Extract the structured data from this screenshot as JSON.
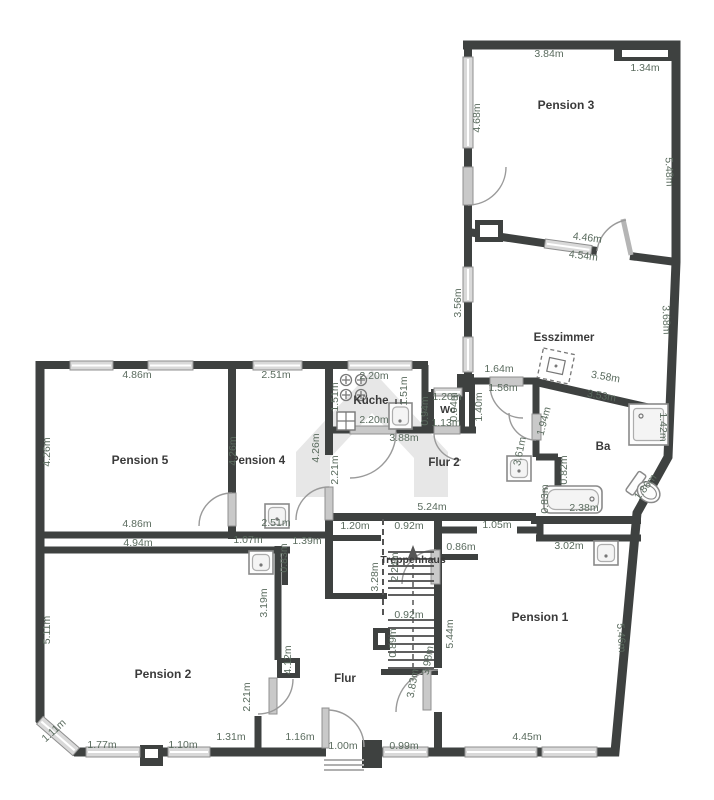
{
  "plan": {
    "type": "floor-plan",
    "language": "de",
    "watermark": "house-logo-watermark"
  },
  "colors": {
    "wall": "#3e4140",
    "dimension_text": "#5a6b5e",
    "room_text": "#3a3a3a",
    "window_fill": "#d9d9d9",
    "door_leaf": "#c9c9c9",
    "watermark": "#e7e7e7",
    "fixture_stroke": "#8a8a8a"
  },
  "room_labels": [
    {
      "id": "pension-3",
      "text": "Pension 3",
      "x": 566,
      "y": 109,
      "fs": 12
    },
    {
      "id": "esszimmer",
      "text": "Esszimmer",
      "x": 564,
      "y": 341,
      "fs": 11.5
    },
    {
      "id": "ba",
      "text": "Ba",
      "x": 603,
      "y": 450,
      "fs": 11.5
    },
    {
      "id": "kueche",
      "text": "Küche",
      "x": 371,
      "y": 404,
      "fs": 11.5
    },
    {
      "id": "wc",
      "text": "Wc",
      "x": 448,
      "y": 413,
      "fs": 10.5
    },
    {
      "id": "flur-2",
      "text": "Flur 2",
      "x": 444,
      "y": 466,
      "fs": 11.5
    },
    {
      "id": "treppenhaus",
      "text": "Treppenhaus",
      "x": 413,
      "y": 563,
      "fs": 10.5
    },
    {
      "id": "pension-1",
      "text": "Pension 1",
      "x": 540,
      "y": 621,
      "fs": 12
    },
    {
      "id": "flur",
      "text": "Flur",
      "x": 345,
      "y": 682,
      "fs": 11.5
    },
    {
      "id": "pension-2",
      "text": "Pension 2",
      "x": 163,
      "y": 678,
      "fs": 12
    },
    {
      "id": "pension-4",
      "text": "Pension 4",
      "x": 258,
      "y": 464,
      "fs": 11.5
    },
    {
      "id": "pension-5",
      "text": "Pension 5",
      "x": 140,
      "y": 464,
      "fs": 12
    }
  ],
  "dimension_labels": [
    {
      "text": "3.84m",
      "x": 549,
      "y": 57,
      "rot": 0
    },
    {
      "text": "1.34m",
      "x": 645,
      "y": 71,
      "rot": 0
    },
    {
      "text": "4.68m",
      "x": 480,
      "y": 118,
      "rot": -90
    },
    {
      "text": "5.48m",
      "x": 666,
      "y": 172,
      "rot": 88
    },
    {
      "text": "4.46m",
      "x": 587,
      "y": 241,
      "rot": 7
    },
    {
      "text": "4.54m",
      "x": 583,
      "y": 259,
      "rot": 7
    },
    {
      "text": "3.56m",
      "x": 461,
      "y": 303,
      "rot": -90
    },
    {
      "text": "3.68m",
      "x": 663,
      "y": 320,
      "rot": 88
    },
    {
      "text": "1.64m",
      "x": 499,
      "y": 372,
      "rot": 0
    },
    {
      "text": "1.56m",
      "x": 503,
      "y": 391,
      "rot": 0
    },
    {
      "text": "3.58m",
      "x": 605,
      "y": 380,
      "rot": 10
    },
    {
      "text": "3.53m",
      "x": 601,
      "y": 399,
      "rot": 10
    },
    {
      "text": "1.40m",
      "x": 482,
      "y": 407,
      "rot": -90
    },
    {
      "text": "1.94m",
      "x": 547,
      "y": 422,
      "rot": -75
    },
    {
      "text": "1.42m",
      "x": 660,
      "y": 427,
      "rot": 90
    },
    {
      "text": "3.61m",
      "x": 523,
      "y": 452,
      "rot": -78
    },
    {
      "text": "0.82m",
      "x": 567,
      "y": 470,
      "rot": -90
    },
    {
      "text": "0.83m",
      "x": 548,
      "y": 499,
      "rot": -90
    },
    {
      "text": "2.38m",
      "x": 584,
      "y": 511,
      "rot": 0
    },
    {
      "text": "1.86m",
      "x": 648,
      "y": 489,
      "rot": -52
    },
    {
      "text": "2.20m",
      "x": 374,
      "y": 379,
      "rot": 0
    },
    {
      "text": "1.51m",
      "x": 338,
      "y": 397,
      "rot": -90
    },
    {
      "text": "1.51m",
      "x": 407,
      "y": 391,
      "rot": -90
    },
    {
      "text": "2.20m",
      "x": 374,
      "y": 423,
      "rot": 0
    },
    {
      "text": "3.88m",
      "x": 404,
      "y": 441,
      "rot": 0
    },
    {
      "text": "1.20m",
      "x": 447,
      "y": 400,
      "rot": 0
    },
    {
      "text": "0.94m",
      "x": 428,
      "y": 411,
      "rot": -90
    },
    {
      "text": "1.13m",
      "x": 446,
      "y": 426,
      "rot": 0
    },
    {
      "text": "0.94m",
      "x": 457,
      "y": 407,
      "rot": -90
    },
    {
      "text": "5.24m",
      "x": 432,
      "y": 510,
      "rot": 0
    },
    {
      "text": "2.21m",
      "x": 338,
      "y": 470,
      "rot": -90
    },
    {
      "text": "4.86m",
      "x": 137,
      "y": 378,
      "rot": 0
    },
    {
      "text": "2.51m",
      "x": 276,
      "y": 378,
      "rot": 0
    },
    {
      "text": "4.26m",
      "x": 50,
      "y": 452,
      "rot": -90
    },
    {
      "text": "4.26m",
      "x": 236,
      "y": 451,
      "rot": -90
    },
    {
      "text": "4.26m",
      "x": 319,
      "y": 448,
      "rot": -90
    },
    {
      "text": "4.86m",
      "x": 137,
      "y": 527,
      "rot": 0
    },
    {
      "text": "2.51m",
      "x": 276,
      "y": 526,
      "rot": 0
    },
    {
      "text": "4.94m",
      "x": 138,
      "y": 546,
      "rot": 0
    },
    {
      "text": "1.07m",
      "x": 248,
      "y": 543,
      "rot": 0
    },
    {
      "text": "0.83m",
      "x": 287,
      "y": 558,
      "rot": -90
    },
    {
      "text": "1.39m",
      "x": 307,
      "y": 544,
      "rot": 0
    },
    {
      "text": "3.19m",
      "x": 267,
      "y": 603,
      "rot": -90
    },
    {
      "text": "5.11m",
      "x": 50,
      "y": 630,
      "rot": -90
    },
    {
      "text": "4.12m",
      "x": 291,
      "y": 660,
      "rot": -90
    },
    {
      "text": "2.21m",
      "x": 250,
      "y": 697,
      "rot": -90
    },
    {
      "text": "1.20m",
      "x": 355,
      "y": 529,
      "rot": 0
    },
    {
      "text": "0.92m",
      "x": 409,
      "y": 529,
      "rot": 0
    },
    {
      "text": "1.05m",
      "x": 497,
      "y": 528,
      "rot": 0
    },
    {
      "text": "0.86m",
      "x": 461,
      "y": 550,
      "rot": 0
    },
    {
      "text": "3.02m",
      "x": 569,
      "y": 549,
      "rot": 0
    },
    {
      "text": "2.24m",
      "x": 398,
      "y": 567,
      "rot": -90
    },
    {
      "text": "3.28m",
      "x": 378,
      "y": 577,
      "rot": -90
    },
    {
      "text": "0.92m",
      "x": 409,
      "y": 618,
      "rot": 0
    },
    {
      "text": "0.89m",
      "x": 396,
      "y": 643,
      "rot": -90
    },
    {
      "text": "5.44m",
      "x": 453,
      "y": 634,
      "rot": -90
    },
    {
      "text": "3.98m",
      "x": 431,
      "y": 661,
      "rot": -80
    },
    {
      "text": "3.83m",
      "x": 416,
      "y": 684,
      "rot": -80
    },
    {
      "text": "5.46m",
      "x": 618,
      "y": 638,
      "rot": 86
    },
    {
      "text": "4.45m",
      "x": 527,
      "y": 740,
      "rot": 0
    },
    {
      "text": "1.11m",
      "x": 56,
      "y": 733,
      "rot": -42
    },
    {
      "text": "1.77m",
      "x": 102,
      "y": 748,
      "rot": 0
    },
    {
      "text": "1.10m",
      "x": 183,
      "y": 748,
      "rot": 0
    },
    {
      "text": "1.31m",
      "x": 231,
      "y": 740,
      "rot": 0
    },
    {
      "text": "1.16m",
      "x": 300,
      "y": 740,
      "rot": 0
    },
    {
      "text": "1.00m",
      "x": 343,
      "y": 749,
      "rot": 0
    },
    {
      "text": "0.99m",
      "x": 404,
      "y": 749,
      "rot": 0
    }
  ],
  "fixtures": [
    {
      "name": "stove-icon",
      "room": "kueche"
    },
    {
      "name": "kitchen-sink-icon",
      "room": "kueche"
    },
    {
      "name": "washbasin-icon",
      "room": "pension-4"
    },
    {
      "name": "washbasin-icon",
      "room": "pension-2"
    },
    {
      "name": "washbasin-icon",
      "room": "flur-2"
    },
    {
      "name": "washbasin-icon",
      "room": "pension-1"
    },
    {
      "name": "shower-icon",
      "room": "ba"
    },
    {
      "name": "bathtub-icon",
      "room": "ba"
    },
    {
      "name": "toilet-icon",
      "room": "ba"
    },
    {
      "name": "staircase-icon",
      "room": "treppenhaus"
    },
    {
      "name": "table-icon",
      "room": "esszimmer"
    }
  ]
}
